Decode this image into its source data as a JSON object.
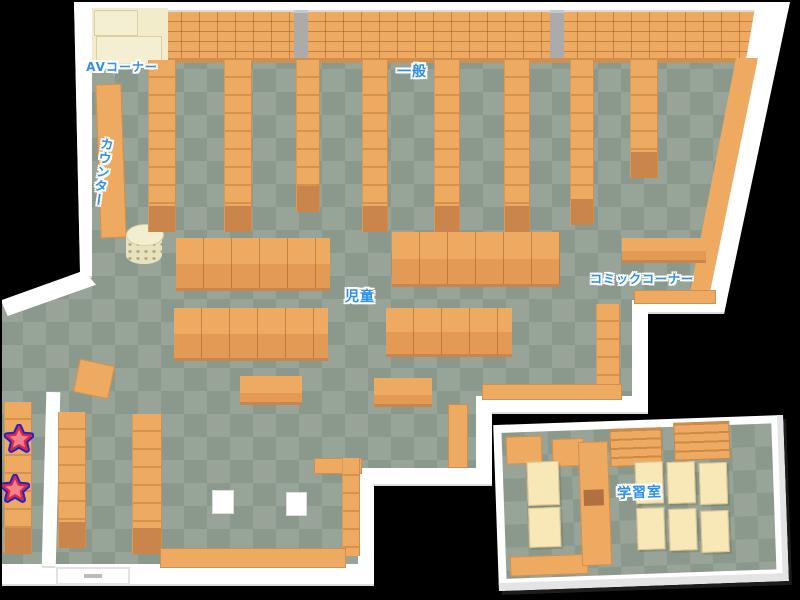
{
  "map": {
    "name": "library-floor-map",
    "areas": {
      "av": {
        "label": "AVコーナー"
      },
      "general": {
        "label": "一般"
      },
      "counter": {
        "label": "カウンター"
      },
      "children": {
        "label": "児童"
      },
      "comic": {
        "label": "コミックコーナー"
      },
      "study": {
        "label": "学習室"
      }
    },
    "markers": [
      {
        "name": "star-marker"
      },
      {
        "name": "star-marker"
      }
    ]
  },
  "colors": {
    "background": "#000000",
    "floor_light": "#97a497",
    "floor_dark": "#8b998c",
    "shelf": "#edaa60",
    "shelf_front": "#c9854b",
    "wall": "#ffffff",
    "wall_shade": "#dcdcdc",
    "pillar": "#ababab",
    "cream": "#f2ecca",
    "cream_edge": "#ddd0a0",
    "table": "#f8e8b8",
    "table_edge": "#ddc489",
    "label": "#2e90e8",
    "star_fill": "#f2808f",
    "star_stroke": "#d92b3d",
    "star_ring": "#2222cc",
    "cylinder": "#e9e2be"
  }
}
